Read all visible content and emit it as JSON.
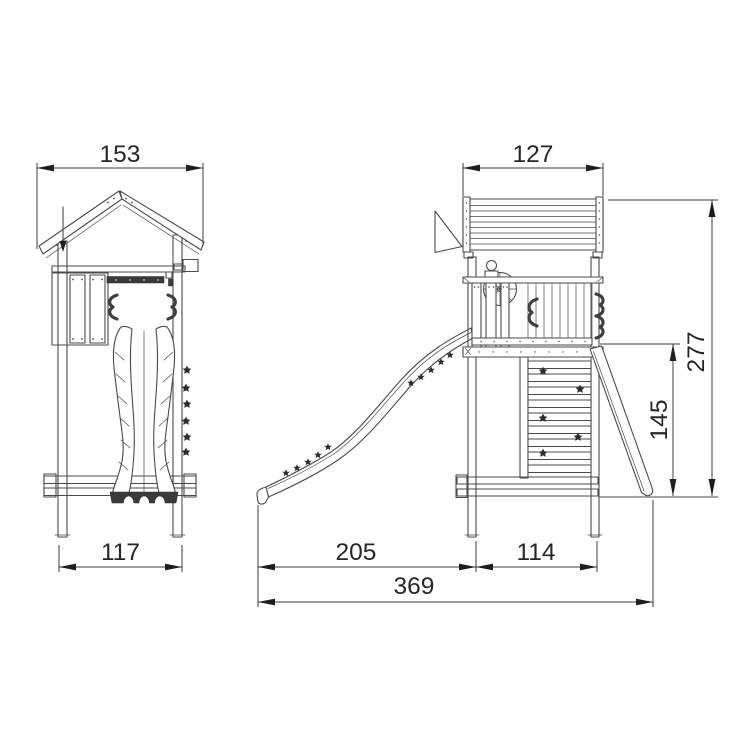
{
  "drawing": {
    "colors": {
      "background": "#ffffff",
      "line": "#4a4a4a",
      "dim_line": "#3c3c3c",
      "text": "#262626",
      "dark_fill": "#3a3a3a"
    },
    "dimensions": {
      "front_roof_width": "153",
      "front_base_width": "117",
      "side_roof_depth": "127",
      "side_total_height": "277",
      "side_platform_height": "145",
      "side_slide_reach": "205",
      "side_frame_depth": "114",
      "side_total_length": "369"
    }
  }
}
